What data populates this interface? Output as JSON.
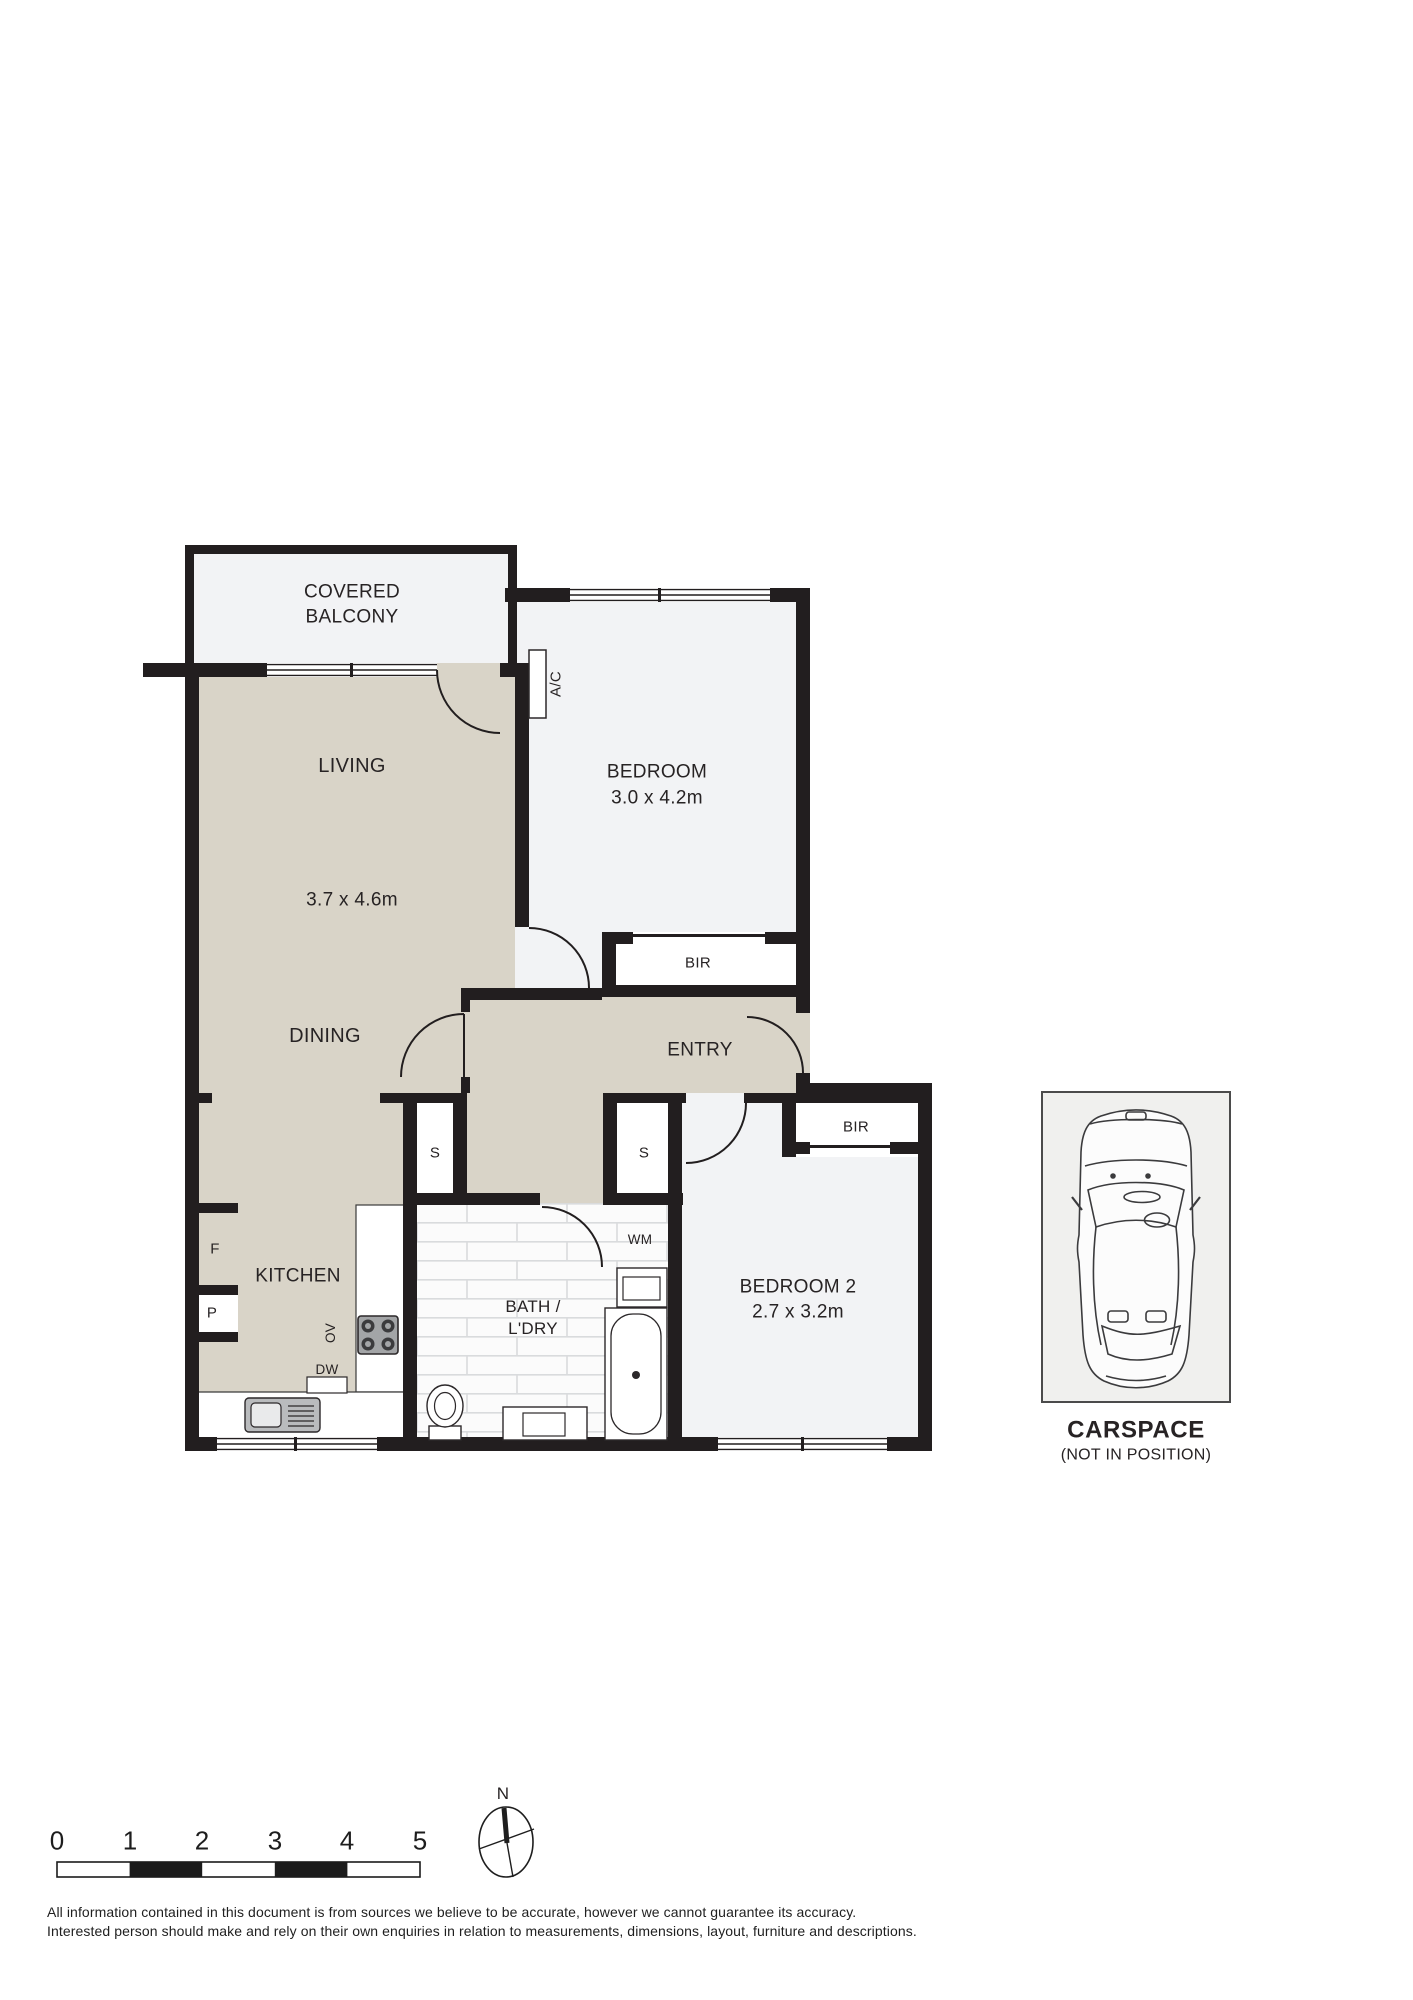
{
  "plan": {
    "rooms": {
      "balcony": {
        "label_line1": "COVERED",
        "label_line2": "BALCONY"
      },
      "living": {
        "label": "LIVING",
        "dimensions": "3.7 x 4.6m"
      },
      "dining": {
        "label": "DINING"
      },
      "entry": {
        "label": "ENTRY"
      },
      "kitchen": {
        "label": "KITCHEN"
      },
      "bath": {
        "label_line1": "BATH /",
        "label_line2": "L'DRY"
      },
      "bedroom1": {
        "label": "BEDROOM",
        "dimensions": "3.0 x 4.2m"
      },
      "bedroom2": {
        "label": "BEDROOM 2",
        "dimensions": "2.7 x 3.2m"
      }
    },
    "features": {
      "ac": "A/C",
      "bir_bedroom1": "BIR",
      "bir_bedroom2": "BIR",
      "storage_left": "S",
      "storage_right": "S",
      "fridge": "F",
      "pantry": "P",
      "oven": "OV",
      "dishwasher": "DW",
      "washing_machine": "WM"
    }
  },
  "carspace": {
    "title": "CARSPACE",
    "subtitle": "(NOT IN POSITION)"
  },
  "compass": {
    "north_label": "N"
  },
  "scale_bar": {
    "ticks": [
      "0",
      "1",
      "2",
      "3",
      "4",
      "5"
    ]
  },
  "disclaimer": {
    "line1": "All information contained in this document is from sources we believe to be accurate, however we cannot guarantee its accuracy.",
    "line2": "Interested person should make and rely on their own enquiries in relation to measurements, dimensions, layout, furniture and descriptions."
  },
  "colors": {
    "floor_beige": "#d9d4c8",
    "floor_light": "#f2f3f5",
    "wall": "#221e1f",
    "tile_line": "#d9dbdd",
    "carspace_fill": "#f0f0ee"
  }
}
